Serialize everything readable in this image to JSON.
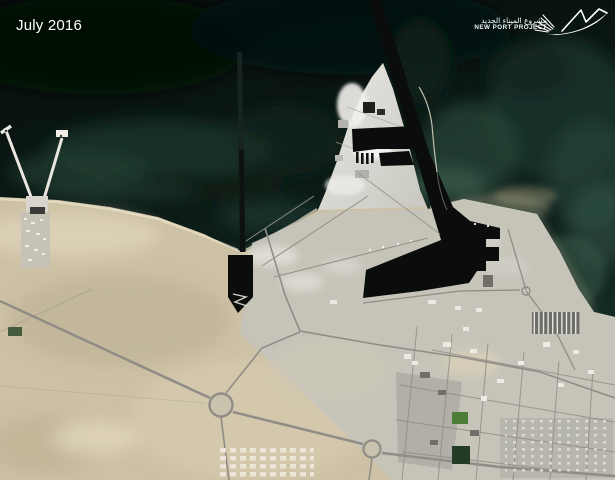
{
  "header": {
    "date_label": "July 2016"
  },
  "logo": {
    "name_ar": "مشروع الميناء الجديد",
    "name_en": "NEW PORT PROJECT",
    "mark": "dhow-sail-swoosh-icon"
  },
  "colors": {
    "sea_dark": "#081110",
    "sea_teal": "#1e4136",
    "lagoon_green": "#3f6253",
    "sand": "#cdc1a5",
    "developed": "#c6c4bb",
    "island": "#dedcd6",
    "harbor_water": "#0a0d0b",
    "road": "#8f8d85",
    "text": "#ffffff"
  }
}
